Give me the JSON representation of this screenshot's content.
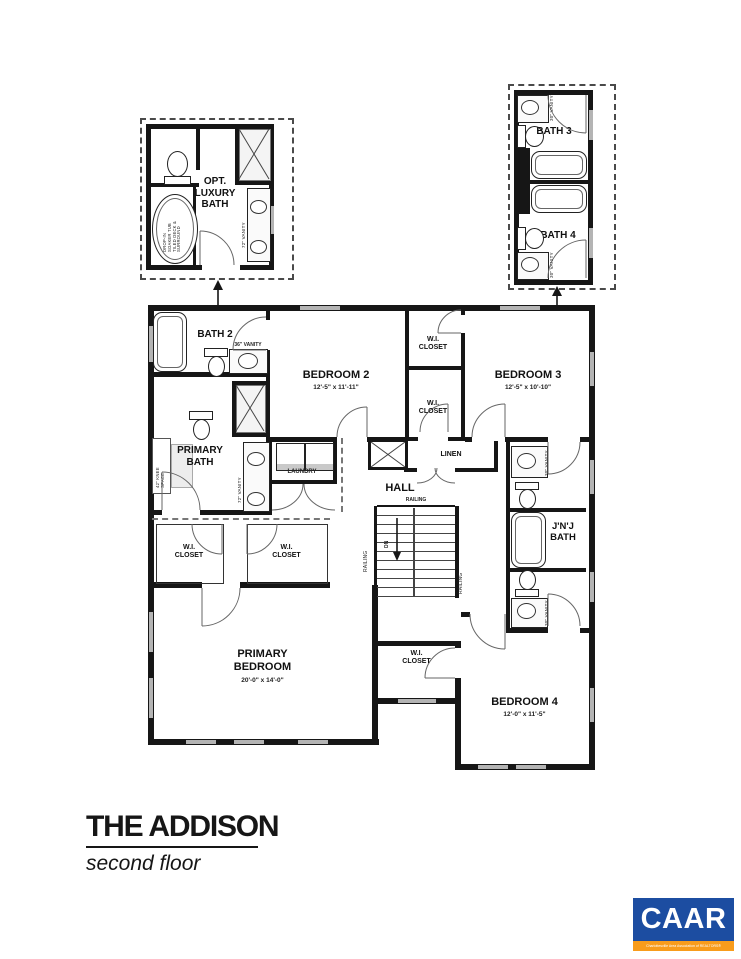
{
  "page": {
    "background": "#ffffff",
    "ink": "#161616",
    "window_color": "#b4b4b4"
  },
  "title_block": {
    "title": "THE ADDISON",
    "subtitle": "second floor"
  },
  "optional_details": {
    "luxury_bath": {
      "label": "OPT.\nLUXURY\nBATH",
      "tub_note": "DROP-IN\nSOAKER TUB\nTILED DECK &\nSURROUND",
      "vanity_label": "72\" VANITY"
    },
    "bath3": {
      "label": "BATH 3",
      "vanity_label": "30\" VANITY"
    },
    "bath4": {
      "label": "BATH 4",
      "vanity_label": "30\" VANITY"
    }
  },
  "rooms": {
    "bath2": {
      "label": "BATH 2",
      "vanity_label": "36\" VANITY"
    },
    "bedroom2": {
      "label": "BEDROOM 2",
      "dims": "12'-5\" x 11'-11\""
    },
    "bedroom3": {
      "label": "BEDROOM 3",
      "dims": "12'-5\" x 10'-10\""
    },
    "bedroom4": {
      "label": "BEDROOM 4",
      "dims": "12'-0\" x 11'-5\""
    },
    "primary_bedroom": {
      "label": "PRIMARY\nBEDROOM",
      "dims": "20'-0\" x 14'-0\""
    },
    "primary_bath": {
      "label": "PRIMARY\nBATH",
      "vanity_label": "72\" VANITY",
      "knee_label": "42\" KNEE\nSPACE"
    },
    "jnj_bath": {
      "label": "J'N'J\nBATH",
      "vanity_label": "30\" VANITY"
    },
    "wi_closet": {
      "label": "W.I.\nCLOSET"
    },
    "laundry": {
      "label": "LAUNDRY"
    },
    "linen": {
      "label": "LINEN"
    },
    "hall": {
      "label": "HALL"
    }
  },
  "stairs": {
    "railing": "RAILING",
    "down": "DN"
  },
  "logo": {
    "text": "CAAR",
    "tagline": "Charlottesville Area Association of REALTORS®",
    "bg_color": "#1c4da1",
    "accent_color": "#f89c1c",
    "text_color": "#ffffff"
  }
}
